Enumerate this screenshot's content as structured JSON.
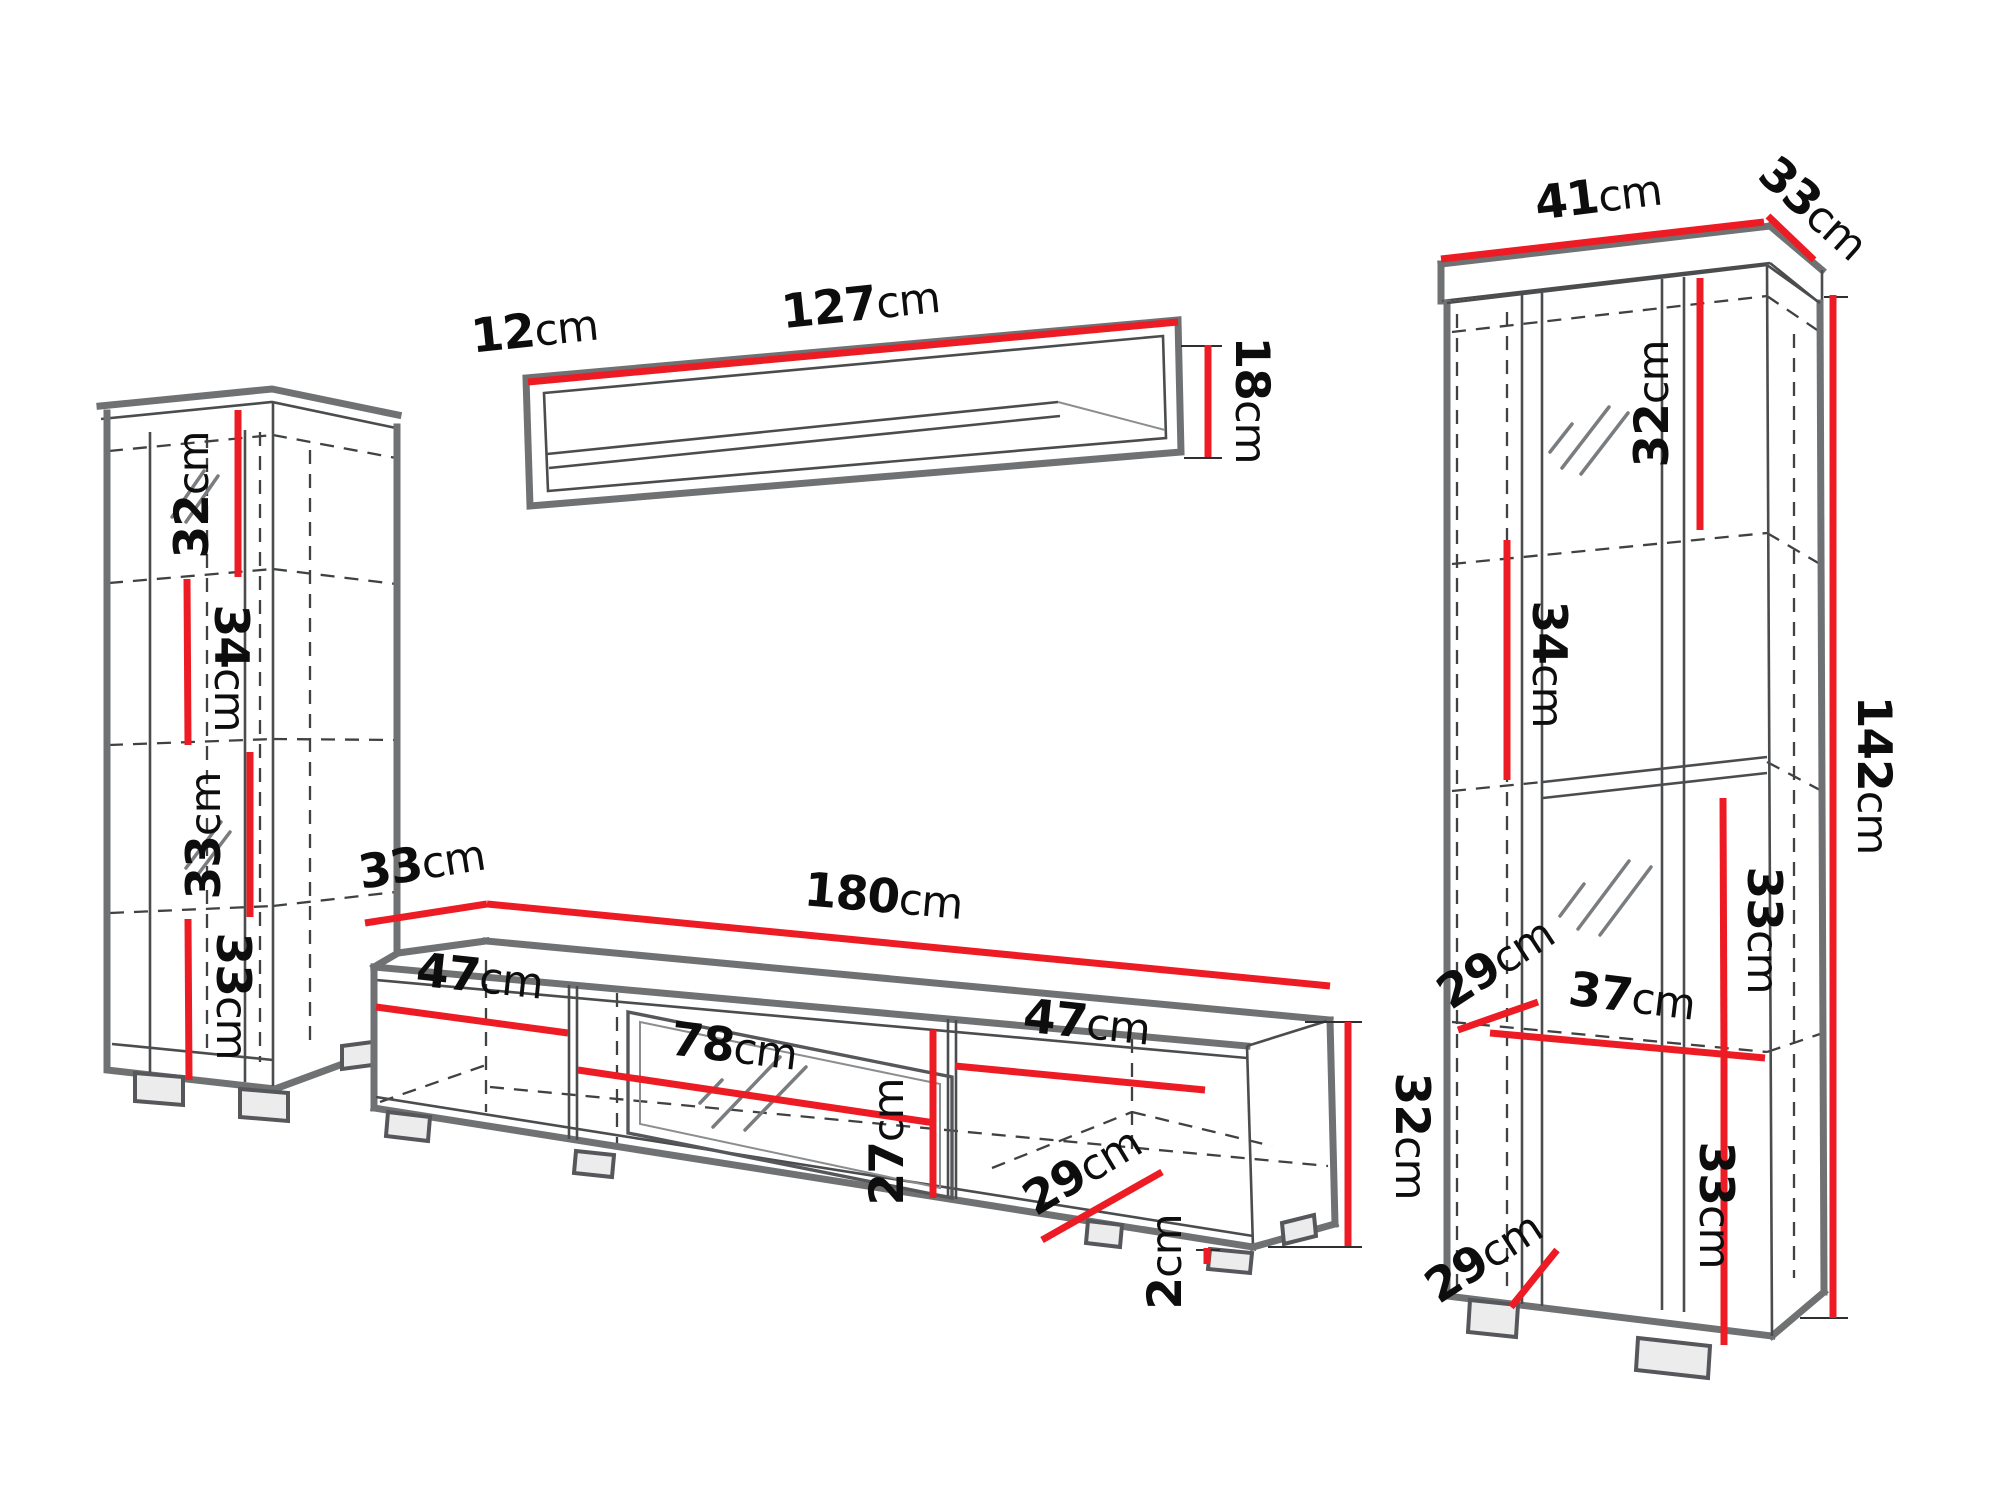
{
  "palette": {
    "dimension_red": "#ed1c24",
    "edge_gray": "#6f7173",
    "line_dark": "#4a4c4e",
    "text_black": "#0d0d0d",
    "background": "#ffffff"
  },
  "pieces": {
    "left_cabinet": {
      "name": "tall-cabinet-left",
      "shelf_sections": [
        {
          "value": "32",
          "unit": "cm"
        },
        {
          "value": "34",
          "unit": "cm"
        },
        {
          "value": "33",
          "unit": "cm"
        },
        {
          "value": "33",
          "unit": "cm"
        }
      ]
    },
    "wall_shelf": {
      "name": "wall-shelf",
      "depth": {
        "value": "12",
        "unit": "cm"
      },
      "width": {
        "value": "127",
        "unit": "cm"
      },
      "height": {
        "value": "18",
        "unit": "cm"
      }
    },
    "tv_stand": {
      "name": "tv-stand",
      "depth": {
        "value": "33",
        "unit": "cm"
      },
      "width": {
        "value": "180",
        "unit": "cm"
      },
      "left_compartment_width": {
        "value": "47",
        "unit": "cm"
      },
      "niche_width": {
        "value": "78",
        "unit": "cm"
      },
      "niche_height": {
        "value": "27",
        "unit": "cm"
      },
      "right_compartment_width": {
        "value": "47",
        "unit": "cm"
      },
      "inner_depth": {
        "value": "29",
        "unit": "cm"
      },
      "plinth_height": {
        "value": "2",
        "unit": "cm"
      },
      "height": {
        "value": "32",
        "unit": "cm"
      }
    },
    "right_cabinet": {
      "name": "display-cabinet-right",
      "width": {
        "value": "41",
        "unit": "cm"
      },
      "depth": {
        "value": "33",
        "unit": "cm"
      },
      "top_section": {
        "value": "32",
        "unit": "cm"
      },
      "second_section": {
        "value": "34",
        "unit": "cm"
      },
      "height": {
        "value": "142",
        "unit": "cm"
      },
      "third_section": {
        "value": "33",
        "unit": "cm"
      },
      "inner_depth_top": {
        "value": "29",
        "unit": "cm"
      },
      "inner_width": {
        "value": "37",
        "unit": "cm"
      },
      "bottom_section": {
        "value": "33",
        "unit": "cm"
      },
      "inner_depth_bottom": {
        "value": "29",
        "unit": "cm"
      }
    }
  }
}
